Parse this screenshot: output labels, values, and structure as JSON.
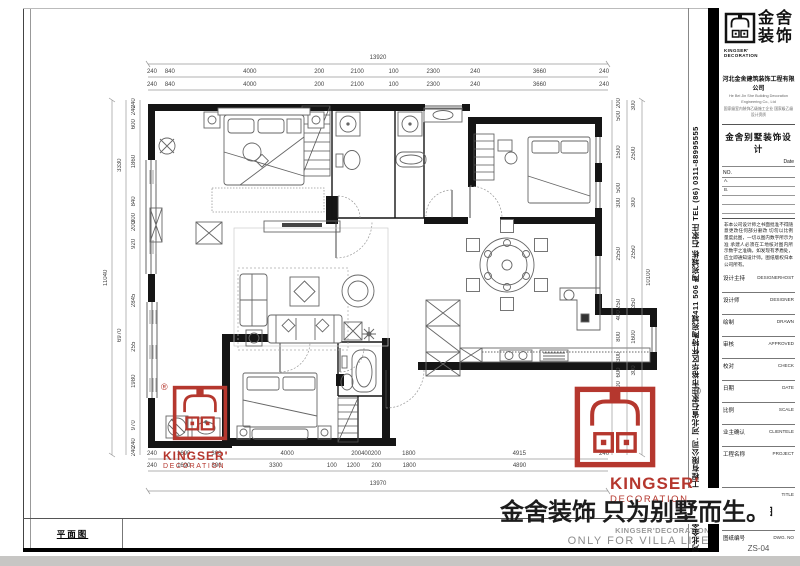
{
  "sheet": {
    "plan_label": "平面图",
    "slogan_zh": "金舍装饰 只为别墅而生。",
    "slogan_en_line1": "KINGSER'DECORATION",
    "slogan_en_line2": "ONLY FOR VILLA LIFE",
    "reg_mark": "®"
  },
  "stamp": {
    "brand_top": "KINGSER'",
    "brand_bottom": "DECORATION",
    "color": "#b5372e"
  },
  "side_strip": {
    "text": "河北金舍建筑装饰工程有限公司. 河北省石家庄市裕华区怀特陶宛城411 506 陶宛城栋 石家庄 TEL (86) 0311-88995555"
  },
  "titleblock": {
    "logo_zh1": "金舍",
    "logo_zh2": "装饰",
    "logo_en1": "KINGSER'",
    "logo_en2": "DECORATION",
    "company": "河北金舍建筑装饰工程有限公司",
    "company_en": "He Bei Jin She Building Decoration Engineering Co., Ltd",
    "qualification": "国家级室内装饰乙级施工企业 国家级乙级设计资质",
    "series_title": "金舍别墅装饰设计",
    "date_label": "Date",
    "no_label": "NO.",
    "ruled_lines": [
      "A.",
      "B.",
      "",
      ""
    ],
    "disclaimer": "非本公司设计师之书面批准不得随意更改任何部分删改 切勿以比例量度此图，一切以图内数字所示为准 承建人必须在工地核对图内所示数字之准确，如发现有矛盾处，应立即通知设计师。图纸版权归本公司所有。",
    "rows": [
      {
        "zh": "设计主持",
        "en": "DESIGNERHOST"
      },
      {
        "zh": "设计师",
        "en": "DESIGNER"
      },
      {
        "zh": "绘制",
        "en": "DRAWN"
      },
      {
        "zh": "审核",
        "en": "APPROVED"
      },
      {
        "zh": "校对",
        "en": "CHECK"
      },
      {
        "zh": "日期",
        "en": "DATE"
      },
      {
        "zh": "比例",
        "en": "SCALE"
      },
      {
        "zh": "业主确认",
        "en": "CLIENTELE"
      }
    ],
    "project_row": {
      "zh": "工程名称",
      "en": "PROJECT"
    },
    "title_row": {
      "zh": "图纸名称",
      "en": "TITLE",
      "value": "平面图"
    },
    "dwg_row": {
      "zh": "图纸编号",
      "en": "DWG. NO",
      "value": "ZS-04"
    }
  },
  "dims": {
    "top_total": [
      {
        "t": "13920",
        "w": 1
      }
    ],
    "top_row1": [
      "240",
      "840",
      "4000",
      "200",
      "2100",
      "100",
      "2300",
      "240",
      "3660",
      "240"
    ],
    "top_row2": [
      "240",
      "840",
      "4000",
      "200",
      "2100",
      "100",
      "2300",
      "240",
      "3660",
      "240"
    ],
    "bottom_row1": [
      "240",
      "1690",
      "300",
      "4000",
      "200",
      "400",
      "200",
      "1800",
      "4915",
      "240"
    ],
    "bottom_row2": [
      "240",
      "1690",
      "300",
      "3300",
      "100",
      "1200",
      "200",
      "1800",
      "4890",
      "240"
    ],
    "bottom_total": [
      {
        "t": "13970",
        "w": 1
      }
    ],
    "left_inner": [
      "240",
      "240",
      "600",
      "1860",
      "840",
      "300",
      "200",
      "920",
      "2845",
      "255",
      "1980",
      "970",
      "240",
      "240"
    ],
    "left_mid": [
      {
        "t": "",
        "w": 480
      },
      {
        "t": "3330",
        "w": 3300
      },
      {
        "t": "",
        "w": 500
      },
      {
        "t": "6970",
        "w": 6970
      },
      {
        "t": "",
        "w": 480
      }
    ],
    "left_total": [
      {
        "t": "",
        "w": 480
      },
      {
        "t": "11040",
        "w": 10770
      },
      {
        "t": "",
        "w": 480
      }
    ],
    "right_inner": [
      "200",
      "500",
      "1500",
      "500",
      "300",
      "2550",
      "250",
      "400",
      "800",
      "300",
      "600",
      "200",
      {
        "t": "",
        "w": 1800
      }
    ],
    "right_outer": [
      "300",
      "2500",
      "300",
      "2550",
      "350",
      "1600",
      "300",
      {
        "t": "",
        "w": 2300
      }
    ],
    "right_total": [
      {
        "t": "",
        "w": 300
      },
      {
        "t": "10100",
        "w": 9500
      },
      {
        "t": "",
        "w": 300
      }
    ]
  }
}
